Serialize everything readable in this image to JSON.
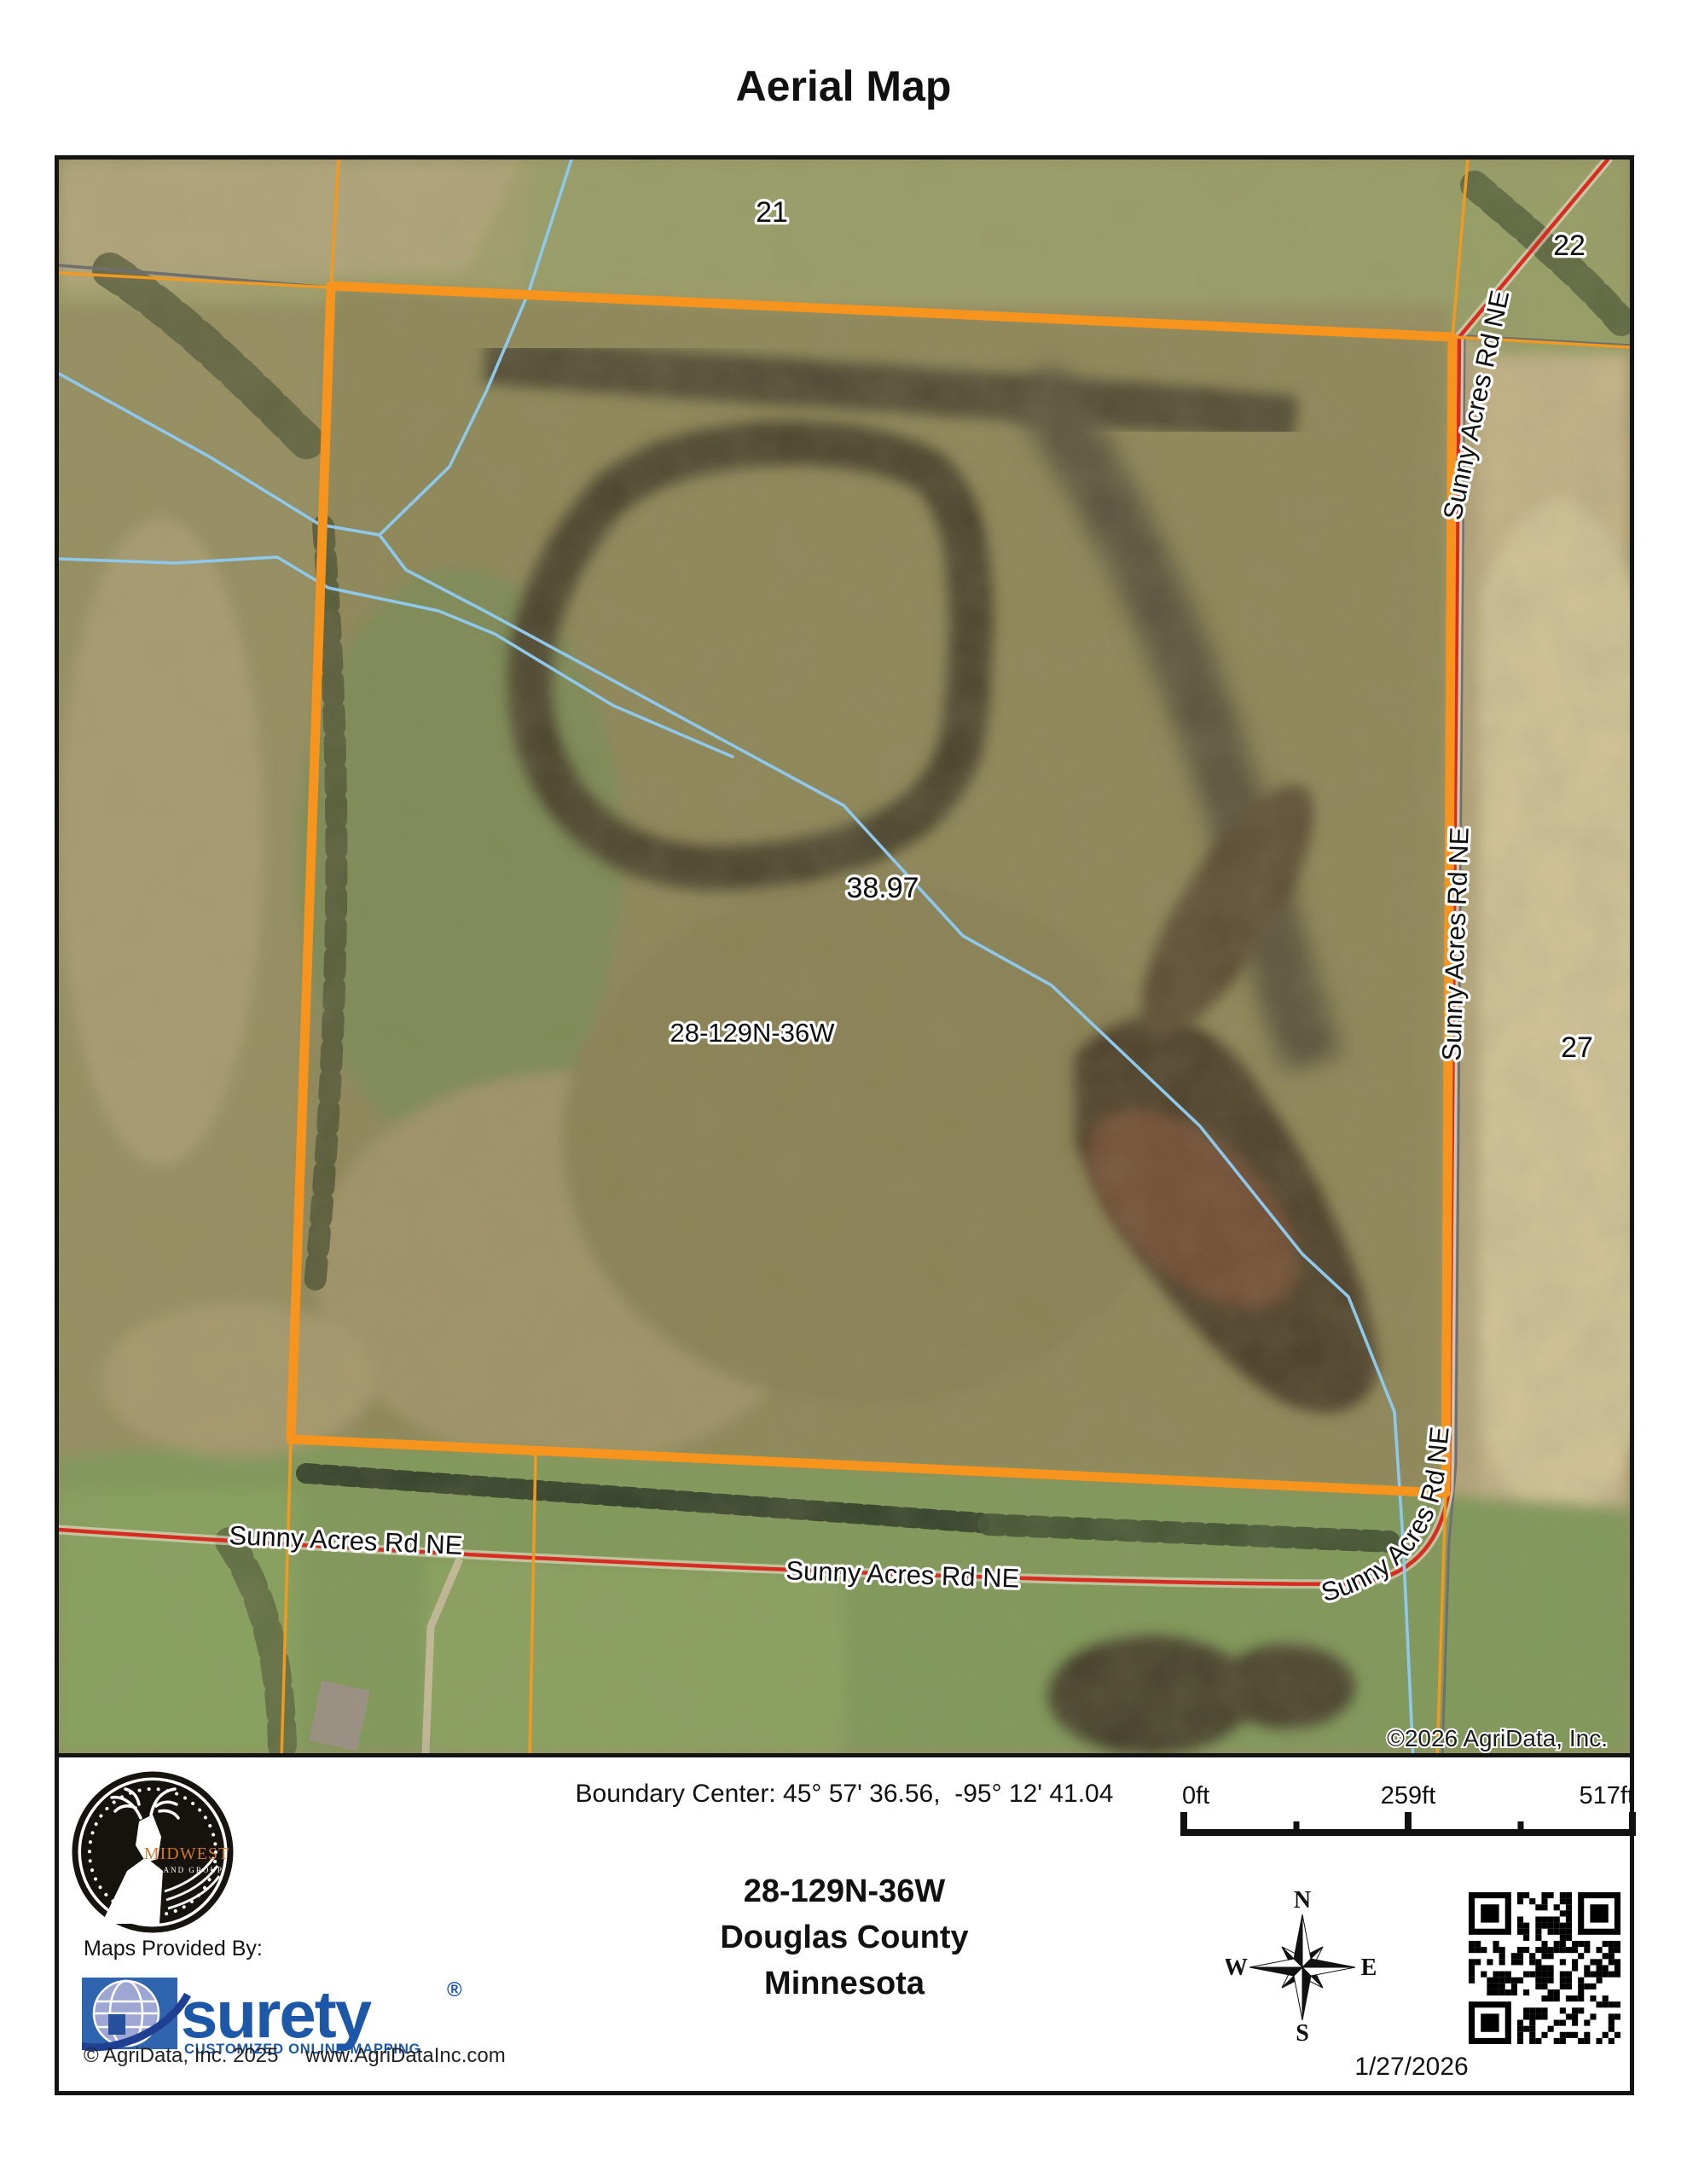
{
  "page": {
    "title": "Aerial Map"
  },
  "map": {
    "road_name": "Sunny Acres Rd NE",
    "section_labels": {
      "s21": "21",
      "s22": "22",
      "s27": "27"
    },
    "parcel": {
      "acreage": "38.97",
      "section_township_range": "28-129N-36W"
    },
    "copyright": "©2026 AgriData, Inc.",
    "colors": {
      "boundary_orange": "#F7941D",
      "road_red": "#D92B1F",
      "road_gray": "#6F6F6F",
      "water_blue": "#8EC8EC"
    }
  },
  "footer": {
    "boundary_center": "Boundary Center: 45° 57' 36.56,  -95° 12' 41.04",
    "location": {
      "str": "28-129N-36W",
      "county": "Douglas County",
      "state": "Minnesota"
    },
    "scale": {
      "start": "0ft",
      "mid": "259ft",
      "end": "517ft"
    },
    "compass": {
      "n": "N",
      "e": "E",
      "s": "S",
      "w": "W"
    },
    "date": "1/27/2026",
    "provider": {
      "label": "Maps Provided By:",
      "brand": "surety",
      "registered": "®",
      "tagline": "CUSTOMIZED ONLINE MAPPING",
      "copyright": "© AgriData, Inc. 2025",
      "website": "www.AgriDataInc.com"
    },
    "logo": {
      "name": "MIDWEST",
      "suffix": "LAND GROUP"
    }
  }
}
